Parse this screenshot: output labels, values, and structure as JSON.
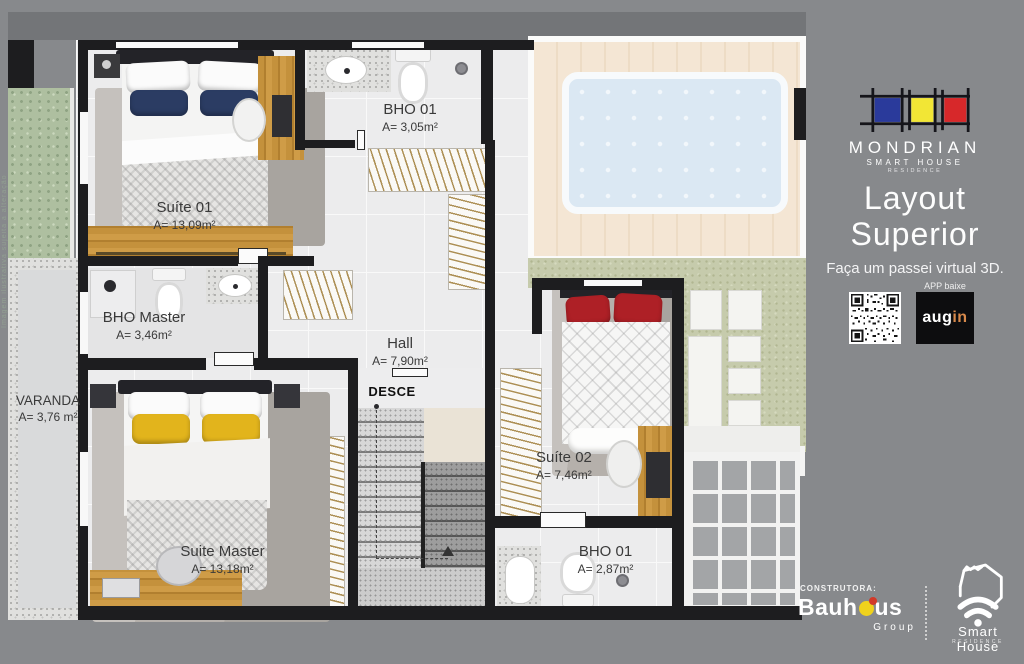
{
  "watermark": "Imagem ilustrativa sujeita a alteração",
  "sidebar": {
    "brand": {
      "name": "MONDRIAN",
      "tagline": "SMART HOUSE",
      "subtag": "RESIDENCE"
    },
    "title_line1": "Layout",
    "title_line2": "Superior",
    "cta": "Faça um passei virtual 3D.",
    "app": {
      "label": "APP baixe",
      "name_left": "aug",
      "name_right": "in"
    },
    "footer": {
      "constructor_label": "CONSTRUTORA:",
      "constructor_pre": "Bauh",
      "constructor_post": "us",
      "constructor_sub": "Group",
      "partner_name": "Smart House",
      "partner_sub": "RESIDENCE"
    }
  },
  "plan": {
    "stairs_label": "DESCE",
    "rooms": [
      {
        "name": "Suíte 01",
        "area": "A= 13,09m²"
      },
      {
        "name": "BHO 01",
        "area": "A= 3,05m²"
      },
      {
        "name": "BHO Master",
        "area": "A= 3,46m²"
      },
      {
        "name": "Hall",
        "area": "A= 7,90m²"
      },
      {
        "name": "VARANDA",
        "area": "A= 3,76 m²"
      },
      {
        "name": "Suíte 02",
        "area": "A= 7,46m²"
      },
      {
        "name": "Suite Master",
        "area": "A= 13,18m²"
      },
      {
        "name": "BHO 01",
        "area": "A= 2,87m²"
      }
    ]
  },
  "colors": {
    "background": "#87898c",
    "mondrian_blue": "#2a3a9b",
    "mondrian_yellow": "#f2e635",
    "mondrian_red": "#d7282a",
    "augin_orange": "#d8894b"
  }
}
